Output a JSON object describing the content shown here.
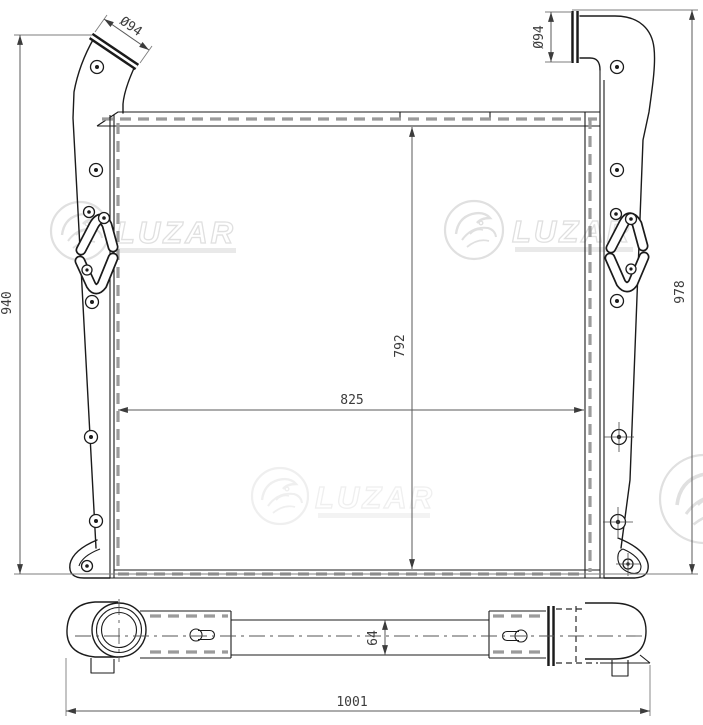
{
  "front_view": {
    "dim_left_height": "940",
    "dim_right_height": "978",
    "dim_core_width": "825",
    "dim_core_height": "792",
    "dim_left_pipe_dia": "Ø94",
    "dim_right_pipe_dia": "Ø94"
  },
  "bottom_view": {
    "dim_depth": "64",
    "dim_overall_length": "1001"
  },
  "watermark": {
    "brand": "LUZAR",
    "color_strong": "#e0e0e0",
    "color_faint": "#efefef"
  },
  "style": {
    "line_color": "#1b1b1b",
    "dim_color": "#5a5a5a",
    "dash_color": "#9b9b9b",
    "background": "#ffffff"
  }
}
